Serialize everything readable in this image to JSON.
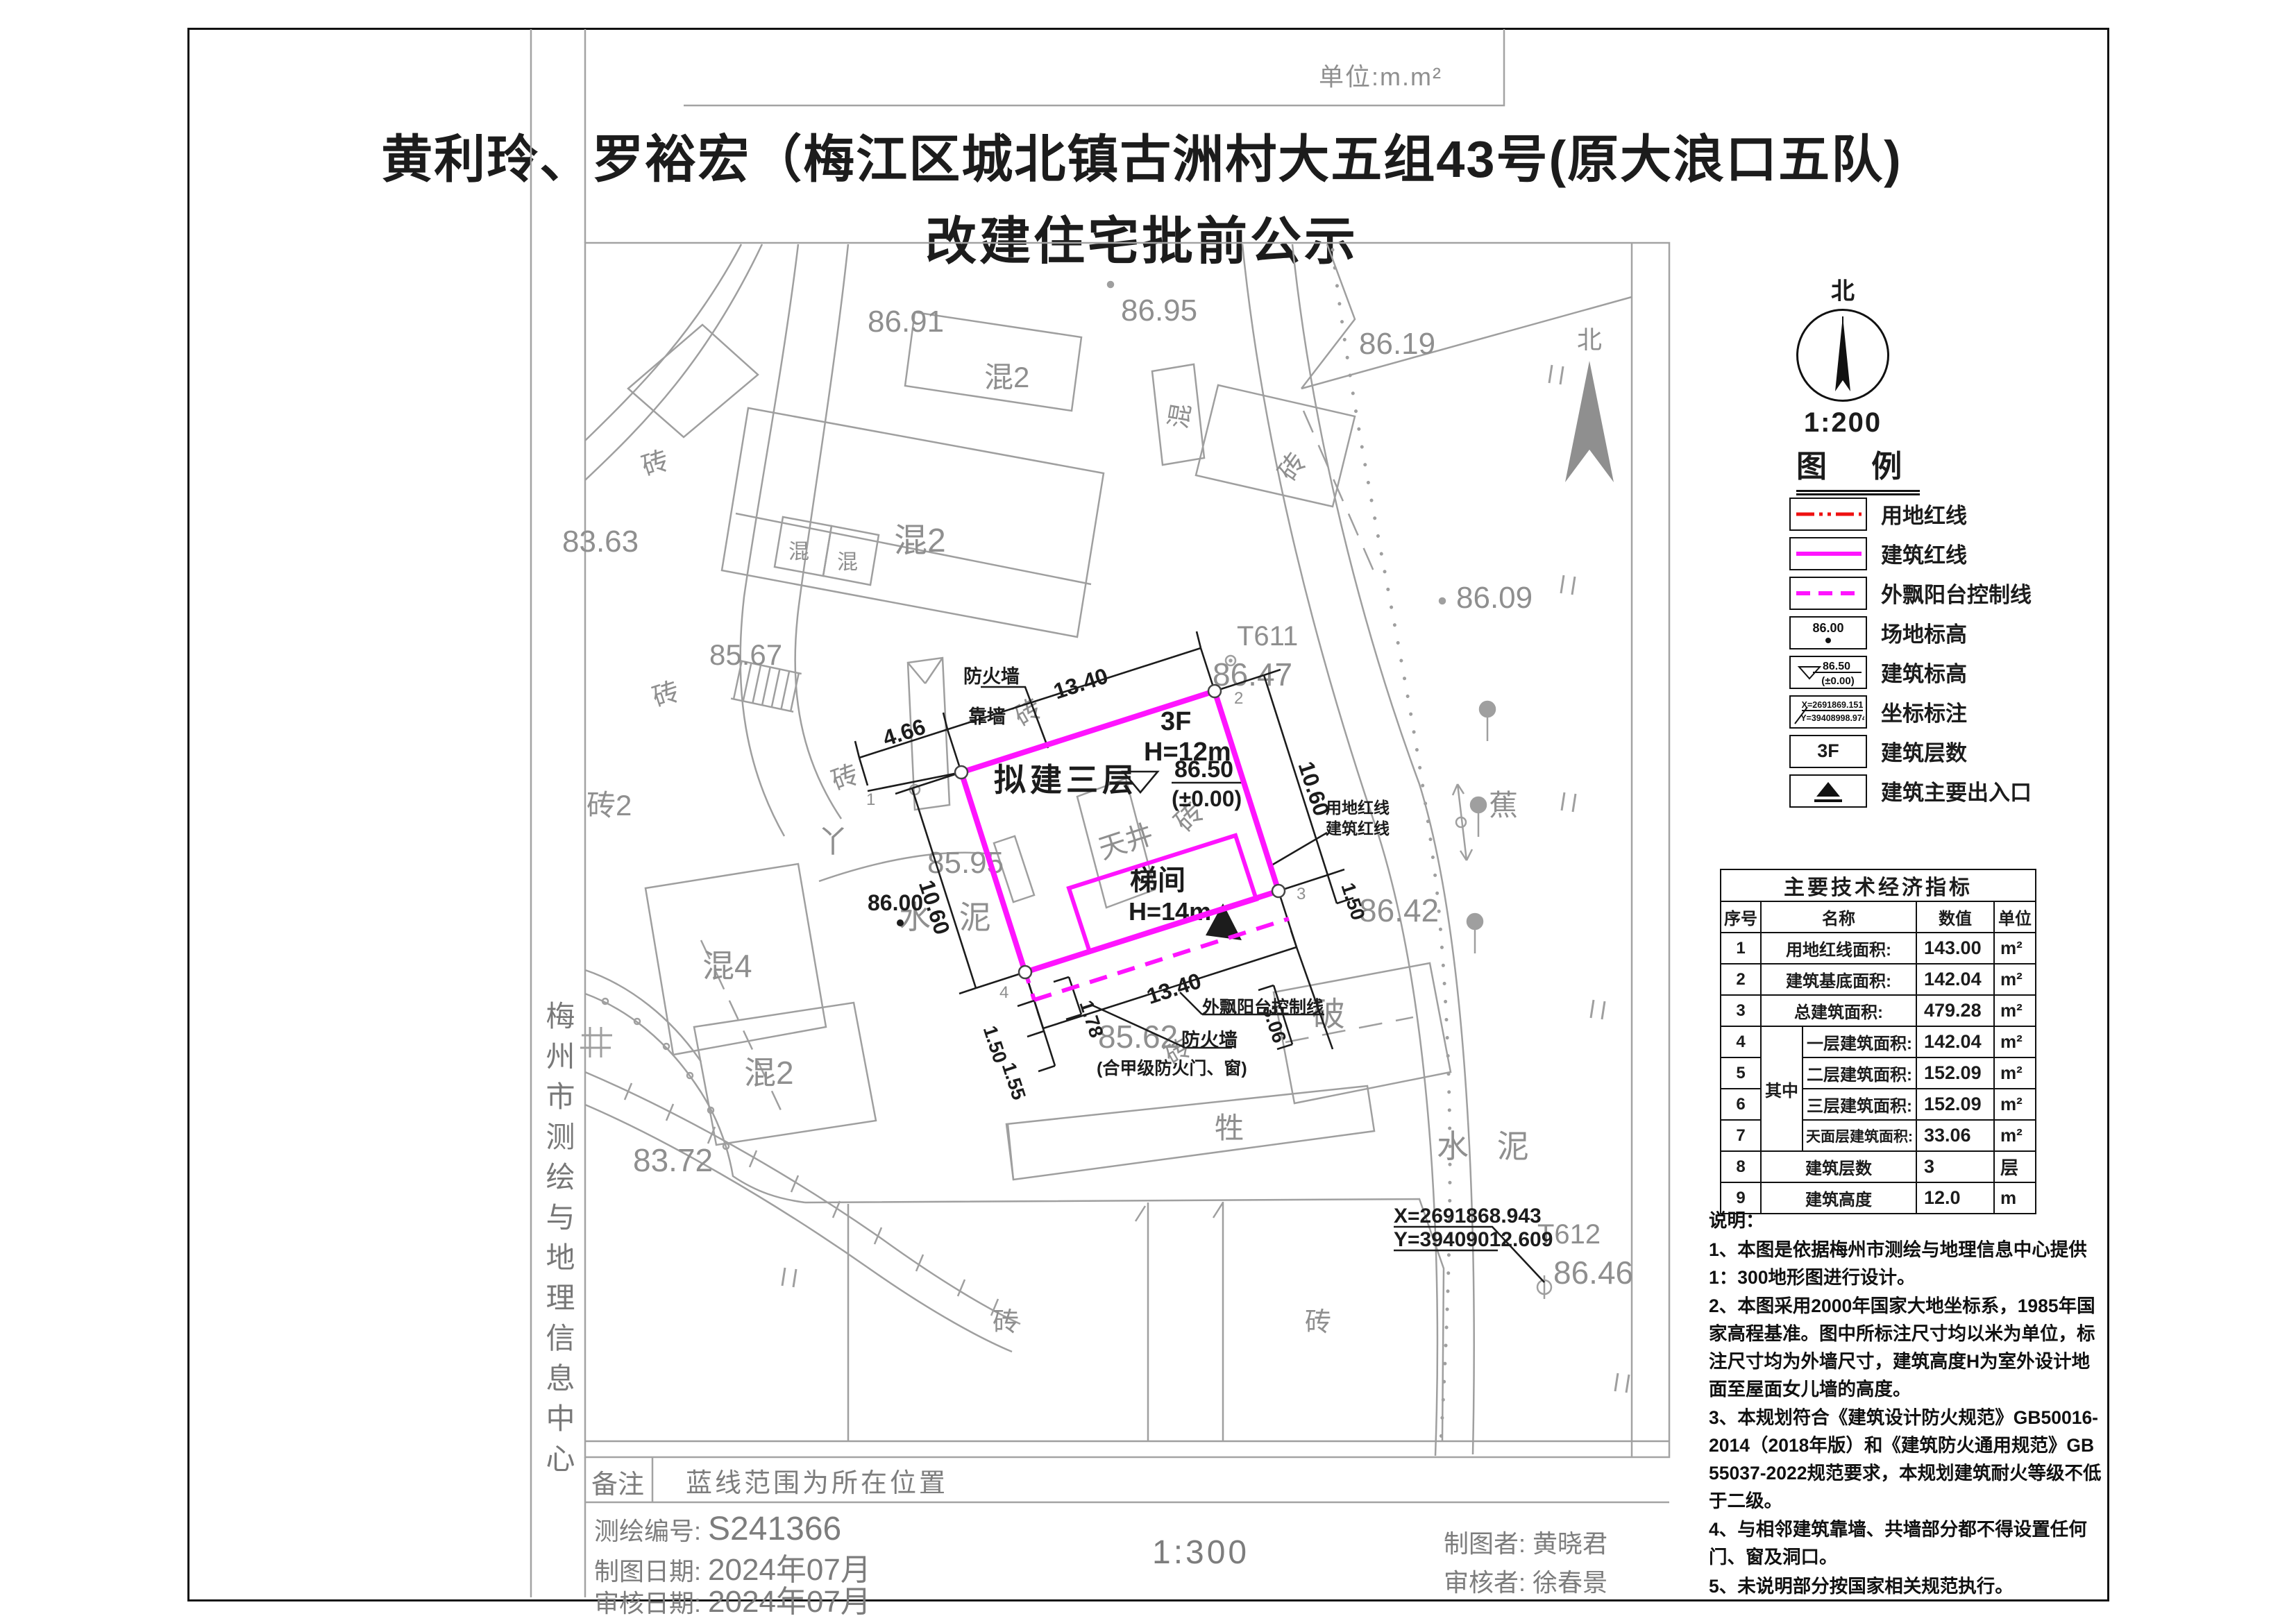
{
  "page": {
    "unit_label": "单位:m.m²",
    "title_line1": "黄利玲、罗裕宏（梅江区城北镇古洲村大五组43号(原大浪口五队)",
    "title_line2": "改建住宅批前公示",
    "side_text": "梅州市测绘与地理信息中心"
  },
  "compass": {
    "north_label": "北",
    "scale": "1:200"
  },
  "legend": {
    "title": "图 例",
    "samples": {
      "site_elev": "86.00",
      "bld_elev_top": "86.50",
      "bld_elev_bottom": "(±0.00)",
      "coord_x": "X=2691869.151",
      "coord_y": "Y=39408998.974",
      "floors": "3F"
    },
    "items": [
      {
        "label": "用地红线"
      },
      {
        "label": "建筑红线"
      },
      {
        "label": "外飘阳台控制线"
      },
      {
        "label": "场地标高"
      },
      {
        "label": "建筑标高"
      },
      {
        "label": "坐标标注"
      },
      {
        "label": "建筑层数"
      },
      {
        "label": "建筑主要出入口"
      }
    ]
  },
  "table": {
    "title": "主要技术经济指标",
    "headers": {
      "no": "序号",
      "name": "名称",
      "value": "数值",
      "unit": "单位"
    },
    "group_label": "其中",
    "rows": [
      {
        "no": "1",
        "name": "用地红线面积:",
        "value": "143.00",
        "unit": "m²"
      },
      {
        "no": "2",
        "name": "建筑基底面积:",
        "value": "142.04",
        "unit": "m²"
      },
      {
        "no": "3",
        "name": "总建筑面积:",
        "value": "479.28",
        "unit": "m²"
      },
      {
        "no": "4",
        "name": "一层建筑面积:",
        "value": "142.04",
        "unit": "m²"
      },
      {
        "no": "5",
        "name": "二层建筑面积:",
        "value": "152.09",
        "unit": "m²"
      },
      {
        "no": "6",
        "name": "三层建筑面积:",
        "value": "152.09",
        "unit": "m²"
      },
      {
        "no": "7",
        "name": "天面层建筑面积:",
        "value": "33.06",
        "unit": "m²"
      },
      {
        "no": "8",
        "name": "建筑层数",
        "value": "3",
        "unit": "层"
      },
      {
        "no": "9",
        "name": "建筑高度",
        "value": "12.0",
        "unit": "m"
      }
    ]
  },
  "notes": {
    "title": "说明：",
    "items": [
      "1、本图是依据梅州市测绘与地理信息中心提供1：300地形图进行设计。",
      "2、本图采用2000年国家大地坐标系，1985年国家高程基准。图中所标注尺寸均以米为单位，标注尺寸均为外墙尺寸，建筑高度H为室外设计地面至屋面女儿墙的高度。",
      "3、本规划符合《建筑设计防火规范》GB50016-2014（2018年版）和《建筑防火通用规范》GB 55037-2022规范要求，本规划建筑耐火等级不低于二级。",
      "4、与相邻建筑靠墙、共墙部分都不得设置任何门、窗及洞口。",
      "5、未说明部分按国家相关规范执行。"
    ]
  },
  "footer": {
    "remark_label": "备注",
    "remark": "蓝线范围为所在位置",
    "survey_no_label": "测绘编号:",
    "survey_no": "S241366",
    "draw_date_label": "制图日期:",
    "draw_date": "2024年07月",
    "review_date_label": "审核日期:",
    "review_date": "2024年07月",
    "scale": "1:300",
    "drafter_label": "制图者:",
    "drafter": "黄晓君",
    "reviewer_label": "审核者:",
    "reviewer": "徐春景"
  },
  "map": {
    "labels": {
      "e8691": "86.91",
      "e8695": "86.95",
      "e8619": "86.19",
      "e8609": "86.09",
      "e8363": "83.63",
      "e8567": "85.67",
      "e8595": "85.95",
      "e8600": "86.00",
      "e8642": "86.42",
      "e8647": "86.47",
      "e8562": "85.62",
      "e8372": "83.72",
      "e8646": "86.46",
      "t611": "T611",
      "t612": "T612",
      "hun_box": "混",
      "hun2_top": "混2",
      "hun2_big": "混2",
      "hun_small_a": "混",
      "hun_small_b": "混",
      "hun4": "混4",
      "hun2_low": "混2",
      "zhuan_tl": "砖",
      "zhuan_rd": "砖",
      "zhuan_right": "砖",
      "zhuan2": "砖2",
      "zhuan_left": "砖",
      "zhuan_dim": "砖",
      "zhuan_in": "砖",
      "zhuan_mid": "砖",
      "zhuan_b1": "砖",
      "zhuan_b2": "砖",
      "po": "破",
      "sheng": "牲",
      "jiao": "蕉",
      "bei": "北",
      "shuini_left": "水 泥",
      "shuini_right": "水 泥",
      "ya": "丫",
      "fire_wall_1": "防火墙",
      "lean_wall": "靠墙",
      "fire_wall_2": "防火墙",
      "fire_wall_2b": "(合甲级防火门、窗)",
      "balcony_line": "外飘阳台控制线",
      "red_line_label": "用地红线",
      "bld_line_label": "建筑红线",
      "proposed": "拟建三层",
      "tianjing": "天井",
      "tijian": "梯间",
      "f3": "3F",
      "h12": "H=12m",
      "h14": "H=14m",
      "e8650": "86.50",
      "pm0": "(±0.00)",
      "coord_x": "X=2691868.943",
      "coord_y": "Y=39409012.609",
      "d1340_top": "13.40",
      "d466": "4.66",
      "d1060_r": "10.60",
      "d1060_l": "10.60",
      "d150_r": "1.50",
      "d1340_bot": "13.40",
      "d178": "1.78",
      "d150_b": "1.50",
      "d155": "1.55",
      "d306": "3.06",
      "v1": "1",
      "v2": "2",
      "v3": "3",
      "v4": "4"
    }
  }
}
